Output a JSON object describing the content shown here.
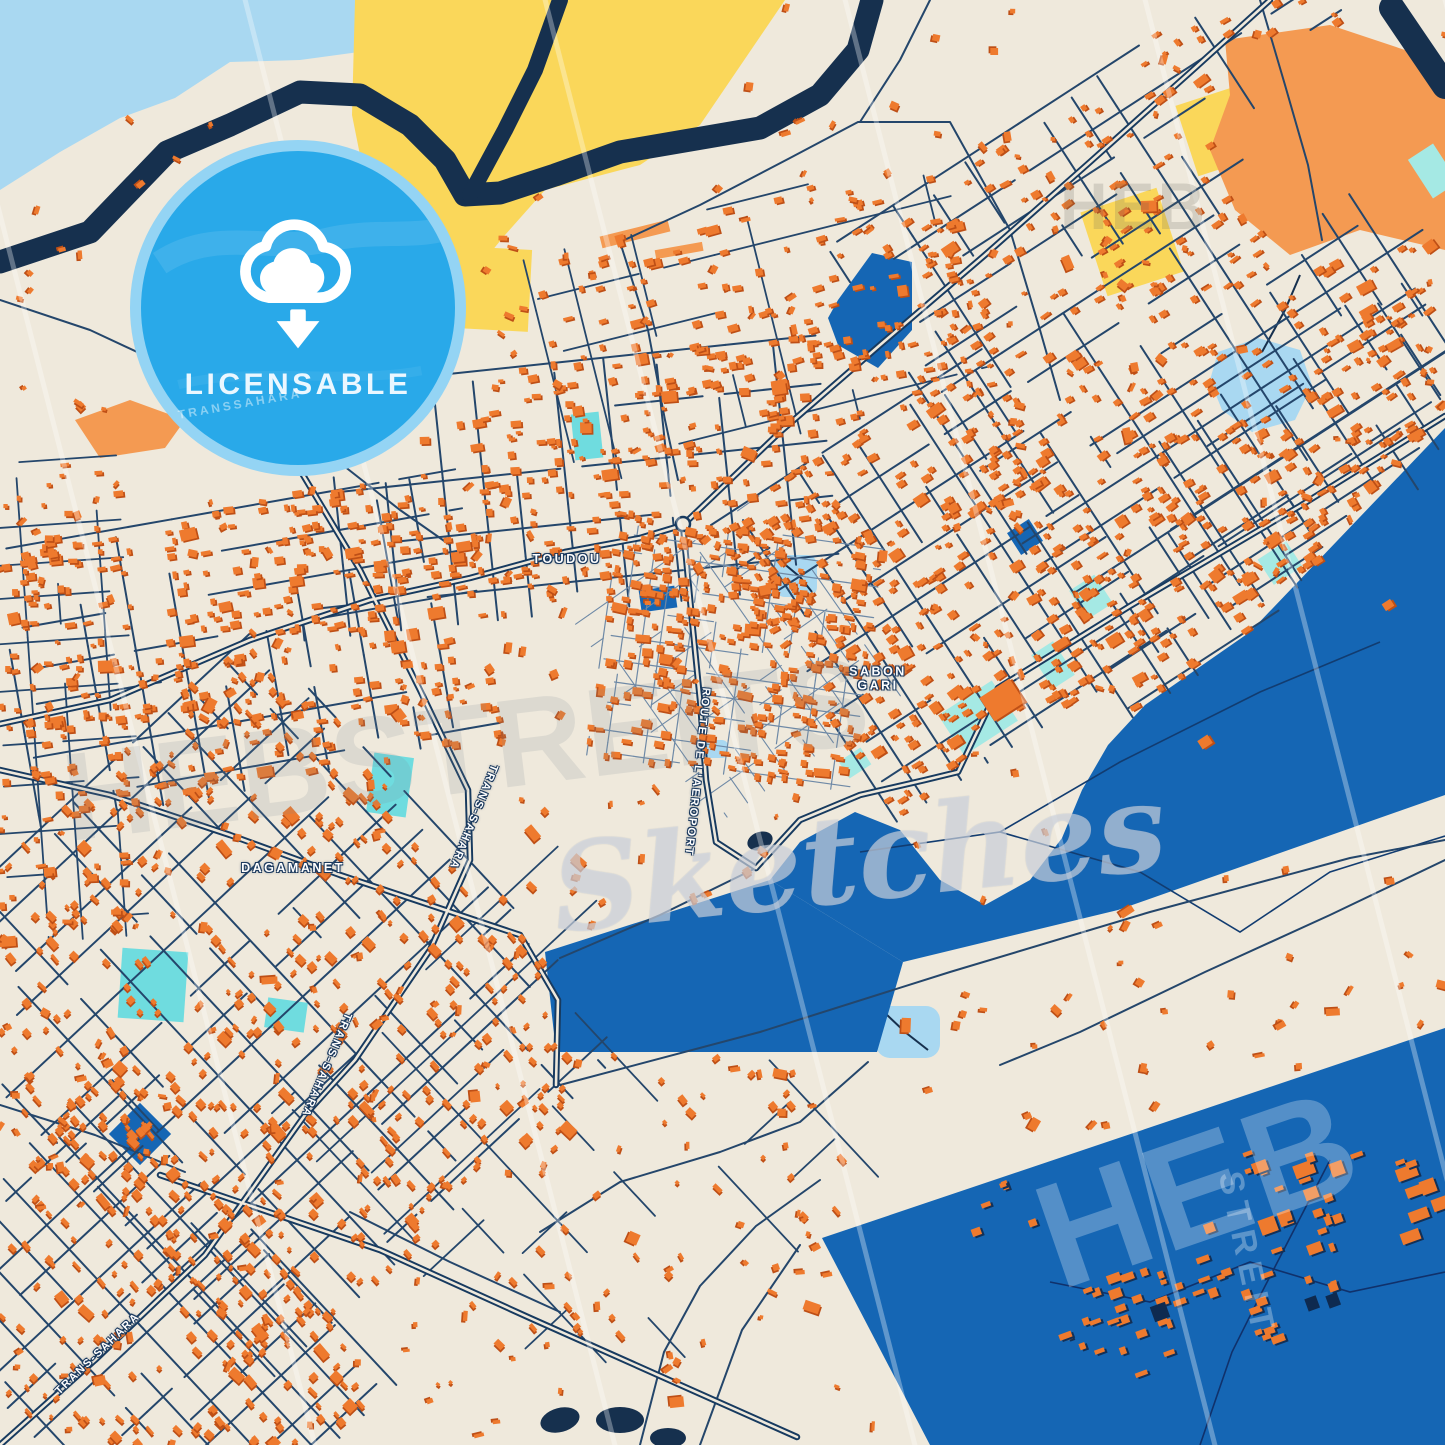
{
  "badge": {
    "label": "LICENSABLE",
    "icon": "cloud-download-icon",
    "color_bg": "#29A9E9",
    "color_fg": "#FFFFFF"
  },
  "watermarks": {
    "top_right": "HEB",
    "center_word": "HEBSTREITS",
    "center_script": "Sketches",
    "bottom_right_word": "HEB",
    "bottom_right_vertical": "STREIT"
  },
  "labels": {
    "districts": [
      {
        "text": "TOUDOU",
        "x": 567,
        "y": 559,
        "rot": 0
      },
      {
        "text": "SABON\nGARI",
        "x": 878,
        "y": 679,
        "rot": 0
      },
      {
        "text": "DAGAMANET",
        "x": 293,
        "y": 868,
        "rot": 0
      }
    ],
    "roads": [
      {
        "text": "TRANS-SAHARA",
        "x": 473,
        "y": 817,
        "rot": 112
      },
      {
        "text": "TRANS-SAHARA",
        "x": 326,
        "y": 1065,
        "rot": 113
      },
      {
        "text": "TRANS-SAHARA",
        "x": 98,
        "y": 1354,
        "rot": -44
      },
      {
        "text": "ROUTE DE L'AEROPORT",
        "x": 697,
        "y": 772,
        "rot": 96
      }
    ],
    "ghost": [
      {
        "text": "TRANSSAHARA",
        "x": 240,
        "y": 404,
        "rot": -10
      }
    ]
  },
  "palette": {
    "land": "#EFE9DC",
    "water_light": "#A9D8F1",
    "water_navy": "#16304E",
    "sand_yellow": "#FAD75A",
    "sand_orange": "#F49A52",
    "airport_blue": "#1566B4",
    "building": "#EE7A2E",
    "building_shadow": "#BE4F16",
    "road_major": "#173A5F",
    "road_minor": "#24466B",
    "road_alley": "#6E89A6",
    "pond_teal": "#6FDCDF",
    "pond_teal_pale": "#A5E9E4",
    "badge_blue": "#29A9E9",
    "watermark_blue": "#4F86C2",
    "watermark_gray": "#D8D3C6"
  }
}
